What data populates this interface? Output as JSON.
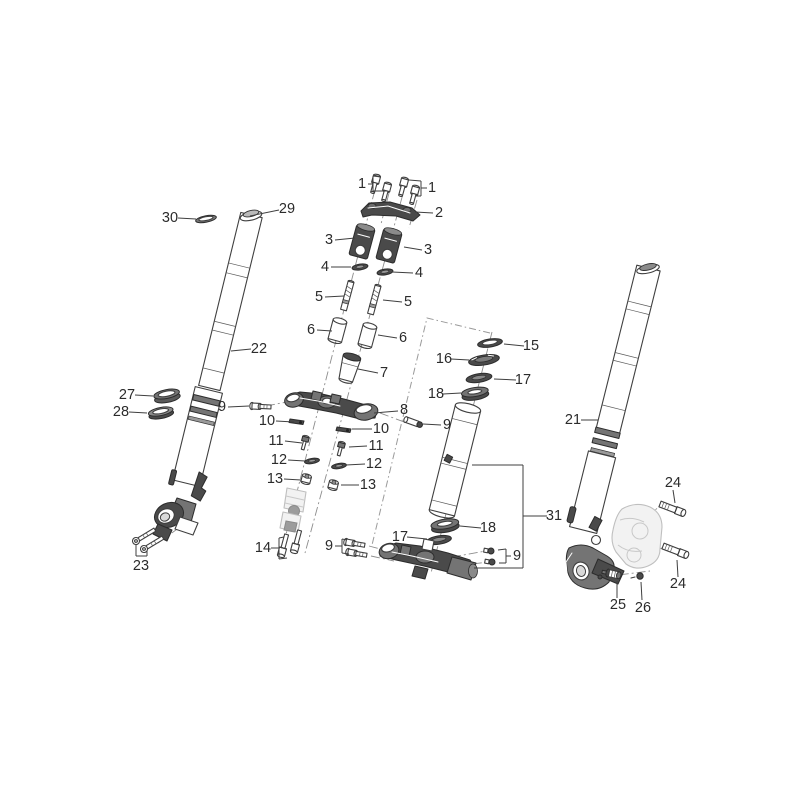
{
  "diagram": {
    "figure_type": "exploded parts diagram",
    "subject": "front fork and steering stem assembly",
    "background_color": "#ffffff",
    "line_color": "#3f3f3f",
    "leader_color": "#3f3f3f",
    "label_color": "#2b2b2b",
    "ghost_color": "#bfbfbf",
    "visible_part_numbers": [
      "1",
      "2",
      "3",
      "4",
      "5",
      "6",
      "7",
      "8",
      "9",
      "10",
      "11",
      "12",
      "13",
      "14",
      "15",
      "16",
      "17",
      "18",
      "21",
      "22",
      "23",
      "24",
      "25",
      "26",
      "27",
      "28",
      "29",
      "30",
      "31"
    ],
    "callouts": [
      {
        "t": "1",
        "x": 362,
        "y": 184,
        "lines": [
          [
            [
              368,
              184
            ],
            [
              373,
              184
            ]
          ],
          [
            [
              373,
              176
            ],
            [
              373,
              191
            ]
          ],
          [
            [
              373,
              176
            ],
            [
              381,
              177
            ]
          ],
          [
            [
              373,
              191
            ],
            [
              388,
              191
            ]
          ]
        ]
      },
      {
        "t": "1",
        "x": 432,
        "y": 188,
        "lines": [
          [
            [
              427,
              188
            ],
            [
              421,
              188
            ]
          ],
          [
            [
              421,
              181
            ],
            [
              421,
              196
            ]
          ],
          [
            [
              421,
              181
            ],
            [
              409,
              180
            ]
          ],
          [
            [
              421,
              196
            ],
            [
              415,
              196
            ]
          ]
        ]
      },
      {
        "t": "2",
        "x": 439,
        "y": 213,
        "lines": [
          [
            [
              433,
              213
            ],
            [
              415,
              212
            ]
          ]
        ]
      },
      {
        "t": "3",
        "x": 329,
        "y": 240,
        "lines": [
          [
            [
              335,
              240
            ],
            [
              355,
              238
            ]
          ]
        ]
      },
      {
        "t": "3",
        "x": 428,
        "y": 250,
        "lines": [
          [
            [
              422,
              250
            ],
            [
              404,
              247
            ]
          ]
        ]
      },
      {
        "t": "4",
        "x": 325,
        "y": 267,
        "lines": [
          [
            [
              331,
              267
            ],
            [
              351,
              267
            ]
          ]
        ]
      },
      {
        "t": "4",
        "x": 419,
        "y": 273,
        "lines": [
          [
            [
              413,
              273
            ],
            [
              392,
              272
            ]
          ]
        ]
      },
      {
        "t": "5",
        "x": 319,
        "y": 297,
        "lines": [
          [
            [
              325,
              297
            ],
            [
              344,
              296
            ]
          ]
        ]
      },
      {
        "t": "5",
        "x": 408,
        "y": 302,
        "lines": [
          [
            [
              402,
              302
            ],
            [
              383,
              300
            ]
          ]
        ]
      },
      {
        "t": "6",
        "x": 311,
        "y": 330,
        "lines": [
          [
            [
              317,
              330
            ],
            [
              332,
              331
            ]
          ]
        ]
      },
      {
        "t": "6",
        "x": 403,
        "y": 338,
        "lines": [
          [
            [
              397,
              338
            ],
            [
              378,
              335
            ]
          ]
        ]
      },
      {
        "t": "7",
        "x": 384,
        "y": 373,
        "lines": [
          [
            [
              378,
              373
            ],
            [
              358,
              369
            ]
          ]
        ]
      },
      {
        "t": "8",
        "x": 404,
        "y": 410,
        "lines": [
          [
            [
              398,
              411
            ],
            [
              374,
              413
            ]
          ]
        ]
      },
      {
        "t": "9",
        "x": 222,
        "y": 407,
        "lines": [
          [
            [
              228,
              407
            ],
            [
              249,
              406
            ]
          ]
        ]
      },
      {
        "t": "9",
        "x": 447,
        "y": 425,
        "lines": [
          [
            [
              441,
              425
            ],
            [
              423,
              424
            ]
          ]
        ]
      },
      {
        "t": "9",
        "x": 329,
        "y": 546,
        "lines": [
          [
            [
              335,
              546
            ],
            [
              342,
              546
            ]
          ],
          [
            [
              342,
              539
            ],
            [
              342,
              553
            ]
          ],
          [
            [
              342,
              539
            ],
            [
              347,
              540
            ]
          ],
          [
            [
              342,
              553
            ],
            [
              349,
              554
            ]
          ]
        ]
      },
      {
        "t": "9",
        "x": 517,
        "y": 556,
        "lines": [
          [
            [
              511,
              556
            ],
            [
              506,
              556
            ]
          ],
          [
            [
              506,
              549
            ],
            [
              506,
              563
            ]
          ],
          [
            [
              506,
              549
            ],
            [
              498,
              550
            ]
          ],
          [
            [
              506,
              563
            ],
            [
              499,
              563
            ]
          ]
        ]
      },
      {
        "t": "10",
        "x": 267,
        "y": 421,
        "lines": [
          [
            [
              276,
              421
            ],
            [
              294,
              422
            ]
          ]
        ]
      },
      {
        "t": "10",
        "x": 381,
        "y": 429,
        "lines": [
          [
            [
              372,
              429
            ],
            [
              352,
              429
            ]
          ]
        ]
      },
      {
        "t": "11",
        "x": 276,
        "y": 441,
        "lines": [
          [
            [
              285,
              441
            ],
            [
              302,
              443
            ]
          ]
        ]
      },
      {
        "t": "11",
        "x": 376,
        "y": 446,
        "lines": [
          [
            [
              367,
              446
            ],
            [
              349,
              447
            ]
          ]
        ]
      },
      {
        "t": "12",
        "x": 279,
        "y": 460,
        "lines": [
          [
            [
              288,
              460
            ],
            [
              305,
              461
            ]
          ]
        ]
      },
      {
        "t": "12",
        "x": 374,
        "y": 464,
        "lines": [
          [
            [
              365,
              464
            ],
            [
              346,
              465
            ]
          ]
        ]
      },
      {
        "t": "13",
        "x": 275,
        "y": 479,
        "lines": [
          [
            [
              284,
              479
            ],
            [
              301,
              480
            ]
          ]
        ]
      },
      {
        "t": "13",
        "x": 368,
        "y": 485,
        "lines": [
          [
            [
              359,
              485
            ],
            [
              341,
              485
            ]
          ]
        ]
      },
      {
        "t": "14",
        "x": 263,
        "y": 548,
        "lines": [
          [
            [
              271,
              548
            ],
            [
              279,
              548
            ]
          ],
          [
            [
              279,
              538
            ],
            [
              279,
              559
            ]
          ],
          [
            [
              279,
              538
            ],
            [
              284,
              537
            ]
          ],
          [
            [
              279,
              559
            ],
            [
              287,
              558
            ]
          ]
        ]
      },
      {
        "t": "15",
        "x": 531,
        "y": 346,
        "lines": [
          [
            [
              524,
              346
            ],
            [
              504,
              344
            ]
          ]
        ]
      },
      {
        "t": "16",
        "x": 444,
        "y": 359,
        "lines": [
          [
            [
              451,
              359
            ],
            [
              469,
              360
            ]
          ]
        ]
      },
      {
        "t": "17",
        "x": 523,
        "y": 380,
        "lines": [
          [
            [
              516,
              380
            ],
            [
              494,
              379
            ]
          ]
        ]
      },
      {
        "t": "18",
        "x": 436,
        "y": 394,
        "lines": [
          [
            [
              443,
              394
            ],
            [
              461,
              393
            ]
          ]
        ]
      },
      {
        "t": "18",
        "x": 488,
        "y": 528,
        "lines": [
          [
            [
              481,
              528
            ],
            [
              460,
              526
            ]
          ]
        ]
      },
      {
        "t": "17",
        "x": 400,
        "y": 537,
        "lines": [
          [
            [
              407,
              537
            ],
            [
              427,
              539
            ]
          ]
        ]
      },
      {
        "t": "21",
        "x": 573,
        "y": 420,
        "lines": [
          [
            [
              581,
              420
            ],
            [
              598,
              420
            ]
          ]
        ]
      },
      {
        "t": "22",
        "x": 259,
        "y": 349,
        "lines": [
          [
            [
              251,
              349
            ],
            [
              231,
              351
            ]
          ]
        ]
      },
      {
        "t": "23",
        "x": 141,
        "y": 566,
        "lines": [
          [
            [
              136,
              545
            ],
            [
              136,
              556
            ]
          ],
          [
            [
              147,
              551
            ],
            [
              147,
              556
            ]
          ],
          [
            [
              136,
              556
            ],
            [
              147,
              556
            ]
          ]
        ]
      },
      {
        "t": "24",
        "x": 673,
        "y": 483,
        "lines": [
          [
            [
              673,
              490
            ],
            [
              675,
              503
            ]
          ]
        ]
      },
      {
        "t": "24",
        "x": 678,
        "y": 584,
        "lines": [
          [
            [
              678,
              577
            ],
            [
              677,
              560
            ]
          ]
        ]
      },
      {
        "t": "25",
        "x": 618,
        "y": 605,
        "lines": [
          [
            [
              617,
              598
            ],
            [
              617,
              581
            ]
          ]
        ]
      },
      {
        "t": "26",
        "x": 643,
        "y": 608,
        "lines": [
          [
            [
              642,
              600
            ],
            [
              641,
              582
            ]
          ]
        ]
      },
      {
        "t": "27",
        "x": 127,
        "y": 395,
        "lines": [
          [
            [
              135,
              395
            ],
            [
              153,
              396
            ]
          ]
        ]
      },
      {
        "t": "28",
        "x": 121,
        "y": 412,
        "lines": [
          [
            [
              129,
              412
            ],
            [
              147,
              413
            ]
          ]
        ]
      },
      {
        "t": "29",
        "x": 287,
        "y": 209,
        "lines": [
          [
            [
              279,
              210
            ],
            [
              250,
              216
            ]
          ]
        ]
      },
      {
        "t": "30",
        "x": 170,
        "y": 218,
        "lines": [
          [
            [
              178,
              218
            ],
            [
              196,
              219
            ]
          ]
        ]
      },
      {
        "t": "31",
        "x": 554,
        "y": 516,
        "lines": [
          [
            [
              547,
              516
            ],
            [
              523,
              516
            ]
          ],
          [
            [
              523,
              465
            ],
            [
              523,
              568
            ]
          ],
          [
            [
              523,
              465
            ],
            [
              472,
              465
            ]
          ],
          [
            [
              523,
              568
            ],
            [
              474,
              568
            ]
          ]
        ]
      }
    ]
  }
}
